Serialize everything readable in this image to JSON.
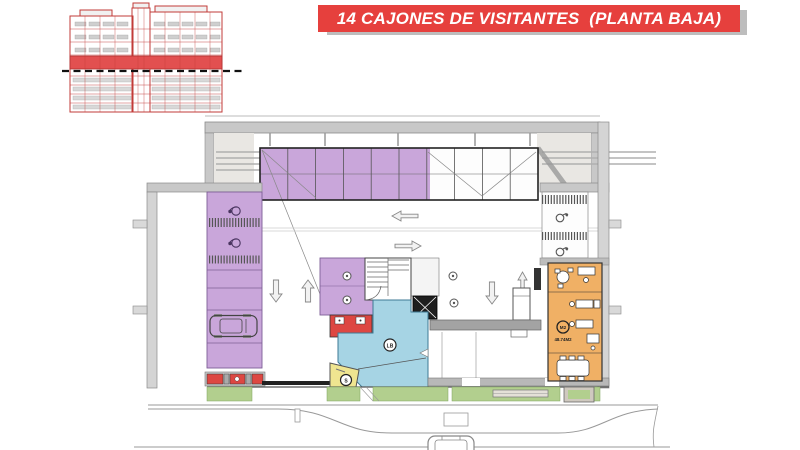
{
  "banner": {
    "title": "14 CAJONES DE VISITANTES  (PLANTA BAJA)",
    "bg_color": "#E6403D",
    "text_color": "#FFFFFF",
    "shadow_color": "#BDBDBD"
  },
  "section_inset": {
    "name": "building-cross-section",
    "line_color": "#C23B38",
    "highlight_color": "#E25050",
    "level_marker": "black-dashed-line"
  },
  "plan": {
    "labels": {
      "lobby_badge": "LB",
      "security_badge": "S",
      "office_badge": "M2",
      "office_area": "48.74M2"
    },
    "colors": {
      "visitor_parking": "#C9A6DA",
      "lobby": "#A6D4E4",
      "office": "#F0B065",
      "security": "#EFE590",
      "service": "#DD4742",
      "landscape": "#B2CF8E",
      "wall": "#C8C8C8",
      "elevator": "#1E1E1E"
    },
    "icons": {
      "accessible_stall": "wheelchair-icon",
      "motorcycle_stall": "motorcycle-icon",
      "parked_car": "car-icon",
      "street_car": "car-icon",
      "flow": "direction-arrow-icon"
    }
  }
}
